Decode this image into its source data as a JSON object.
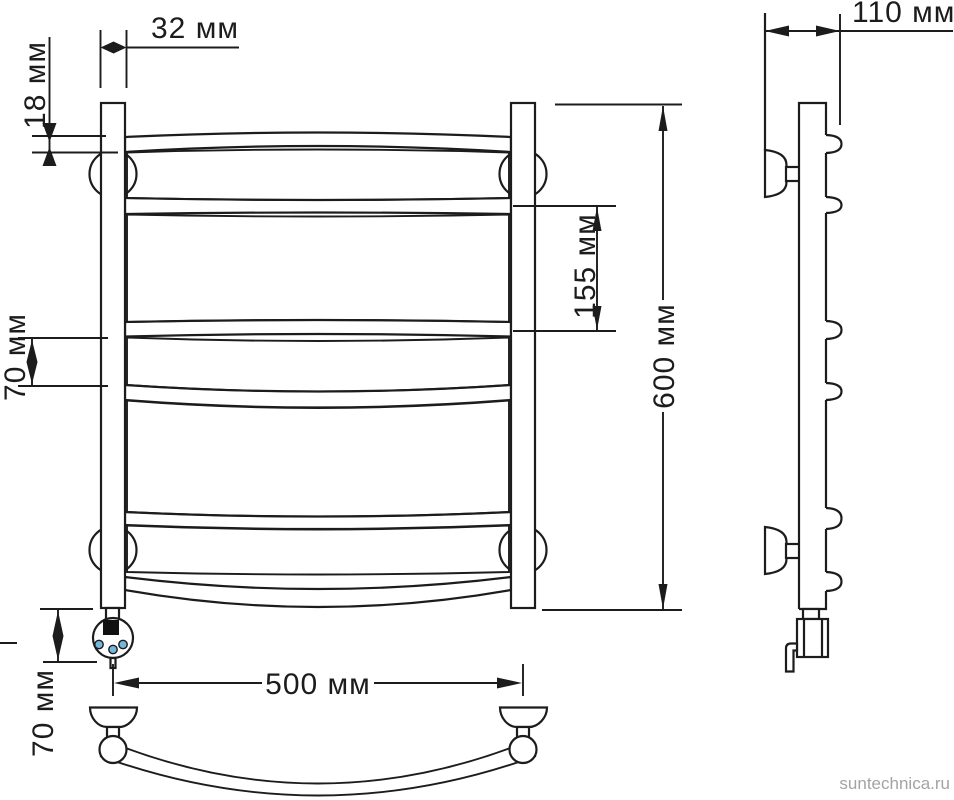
{
  "watermark": {
    "text": "suntechnica.ru"
  },
  "colors": {
    "line": "#1c1c1c",
    "background": "#ffffff",
    "indicator_blue": "#74b7dd",
    "heater_block": "#111111",
    "watermark_gray": "#a3a3a3"
  },
  "dimensions": {
    "post_top_width": {
      "label": "32 мм"
    },
    "tube_offset": {
      "label": "18 мм"
    },
    "wall_depth": {
      "label": "110 мм"
    },
    "section_height": {
      "label": "155 мм"
    },
    "total_height": {
      "label": "600 мм"
    },
    "rung_gap": {
      "label": "70 мм"
    },
    "total_width": {
      "label": "500 мм"
    },
    "heater_offset": {
      "label": "70 мм"
    }
  }
}
